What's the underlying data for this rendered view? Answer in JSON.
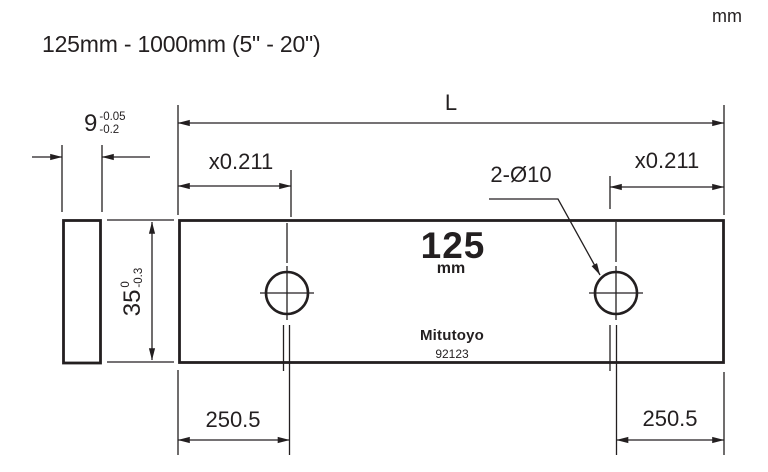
{
  "page": {
    "title": "125mm - 1000mm (5\" - 20\")",
    "unit_label": "mm"
  },
  "drawing": {
    "ink_color": "#231f20",
    "length_label": "L",
    "airy_left_label": "x0.211",
    "airy_right_label": "x0.211",
    "holes_label": "2-Ø10",
    "thickness_dim": {
      "value": "9",
      "tol_upper": "-0.05",
      "tol_lower": "-0.2"
    },
    "height_dim": {
      "value": "35",
      "tol_upper": "0",
      "tol_lower": "-0.3"
    },
    "hole_offset_left": "250.5",
    "hole_offset_right": "250.5",
    "plate_face": {
      "size": "125",
      "unit": "mm",
      "brand": "Mitutoyo",
      "model": "92123"
    }
  }
}
